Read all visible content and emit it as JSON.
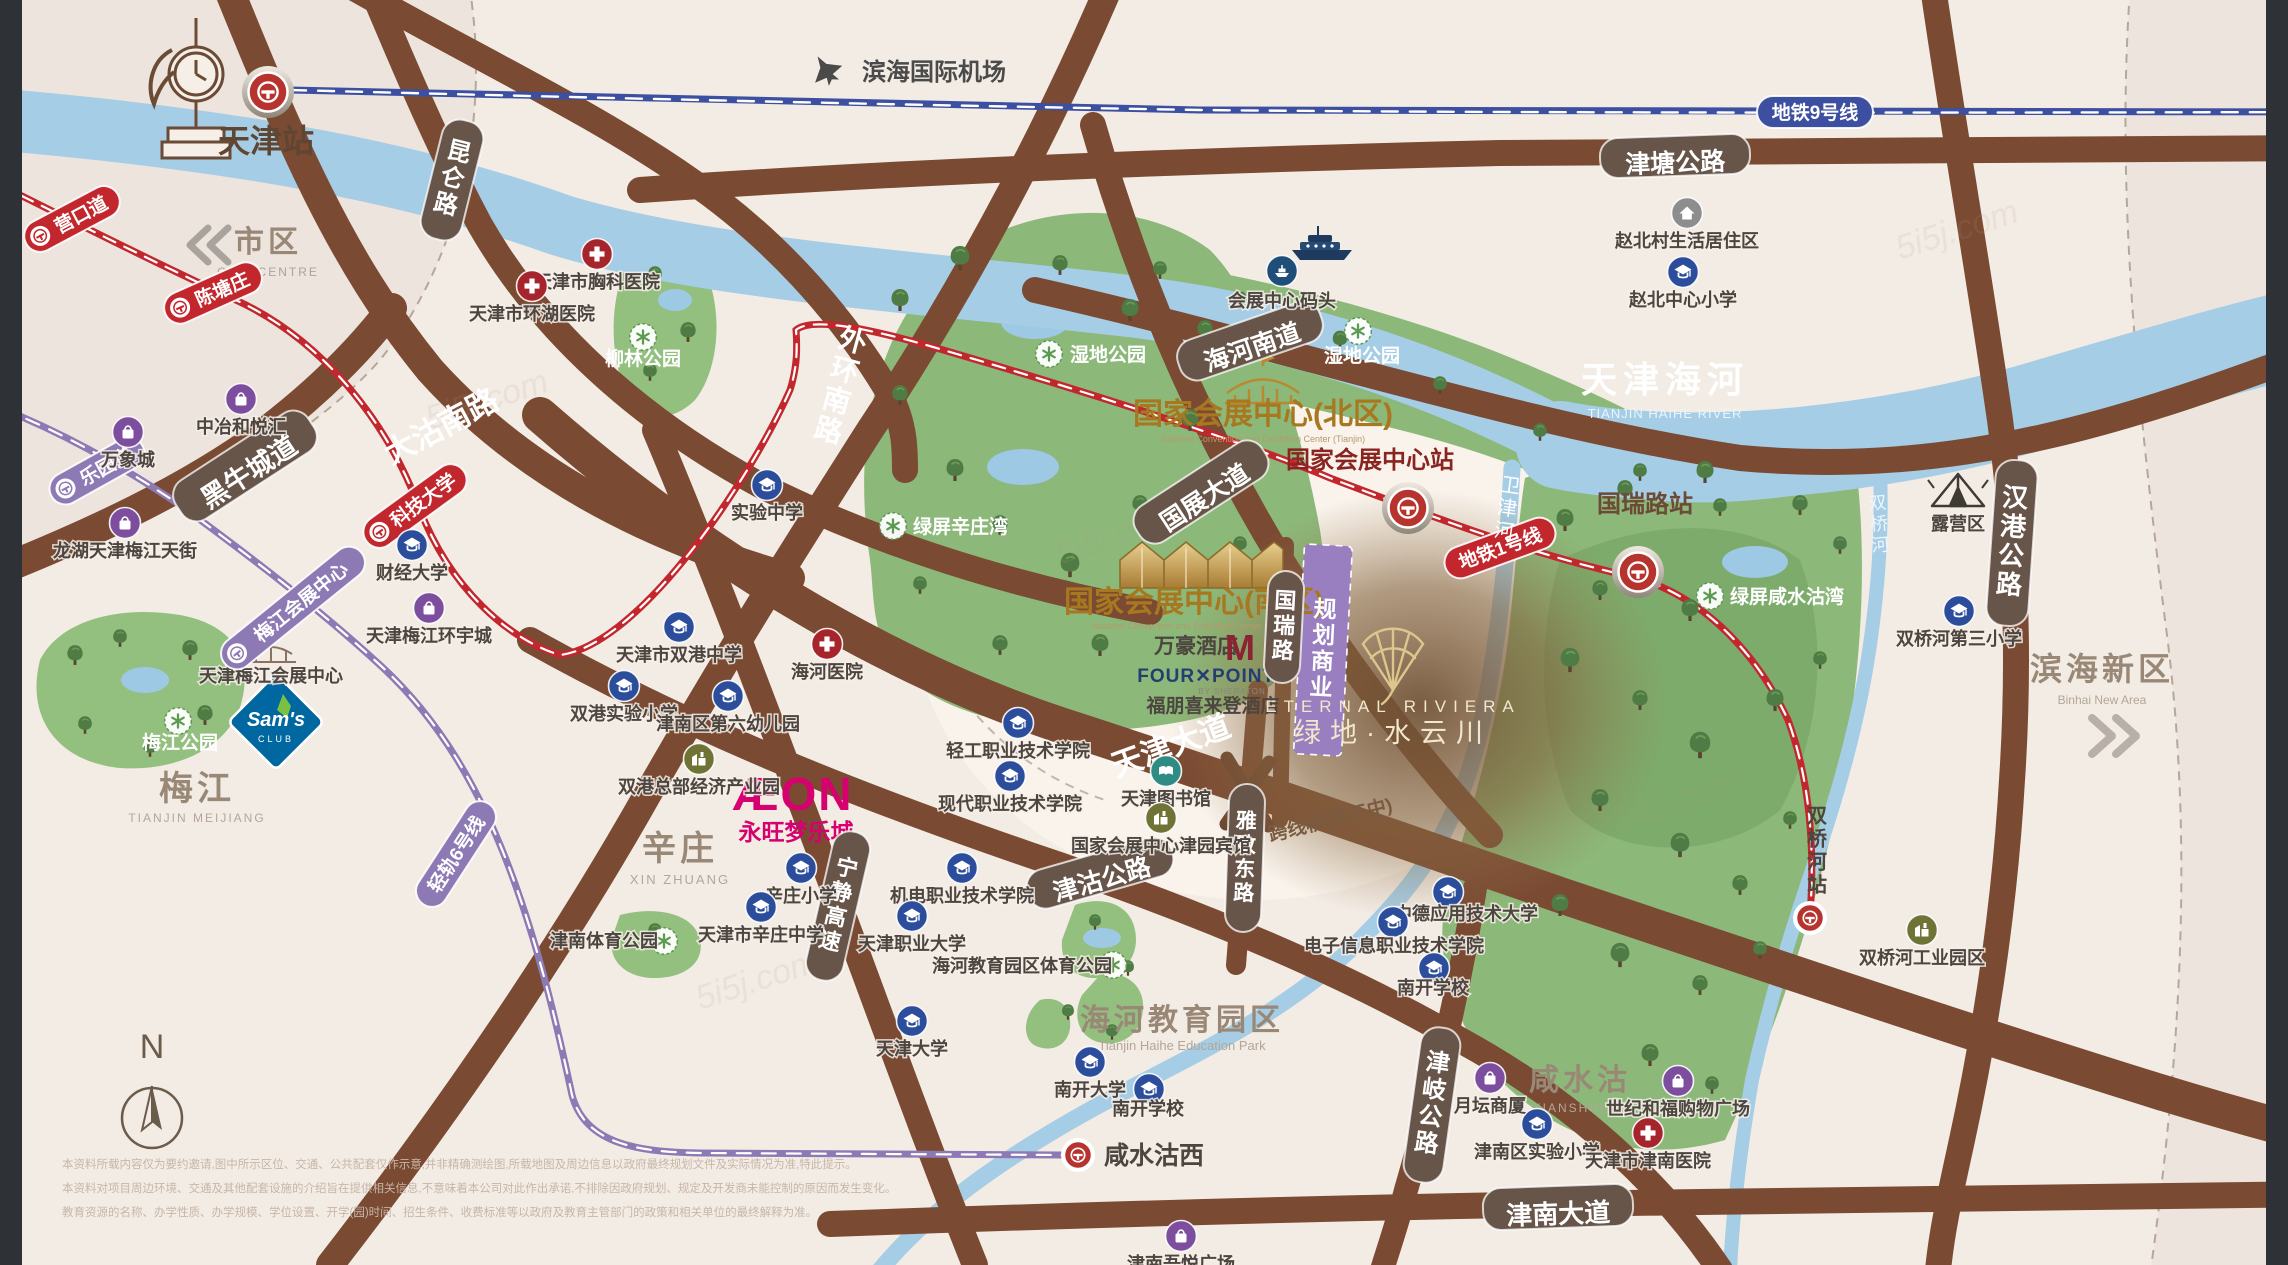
{
  "watermark": "5i5j.com",
  "compass": "N",
  "areas": {
    "city": {
      "label": "市区",
      "en": "CITY CENTRE"
    },
    "meijiang": {
      "label": "梅江",
      "en": "TIANJIN MEIJIANG"
    },
    "xinzhuang": {
      "label": "辛庄",
      "en": "XIN ZHUANG"
    },
    "xianshuigu": {
      "label": "咸水沽",
      "en": "XIANSHUIGU"
    },
    "haihe_edu": {
      "label": "海河教育园区",
      "en": "Tianjin Haihe Education Park"
    },
    "binhai": {
      "label": "滨海新区",
      "en": "Binhai New Area"
    },
    "river": {
      "label": "天津海河",
      "en": "TIANJIN HAIHE RIVER"
    },
    "weijin_river": "卫津河",
    "shuangqiao_river": "双桥河"
  },
  "landmarks": {
    "tianjin_station": "天津站",
    "airport": "滨海国际机场",
    "meijiang_center": "天津梅江会展中心"
  },
  "convention_north": {
    "title": "国家会展中心(北区)",
    "en": "National Convention and Exhibition Center (Tianjin)",
    "station": "国家会展中心站"
  },
  "convention_south": {
    "title": "国家会展中心(南区)",
    "en": "National Convention and Exhibition Center (Tianjin)",
    "hotel1": "万豪酒店",
    "hotel1_logo": "M",
    "hotel2_line1": "FOUR✕POINTS",
    "hotel2_line2": "BY SHERATON",
    "hotel2_cn": "福朋喜来登酒店"
  },
  "project": {
    "name_en": "ETERNAL RIVIERA",
    "name_cn": "绿地·水云川"
  },
  "planning": "规划商业",
  "bridge_note": "跨线桥(施工中)",
  "aeon": {
    "logo": "ÆON",
    "cn": "永旺梦乐城"
  },
  "sams": {
    "line1": "Sam's",
    "line2": "CLUB"
  },
  "guorui_station": "国瑞路站",
  "shuangqiaohe_station": "双桥河站",
  "xianshuigu_west_station": "咸水沽西",
  "metro": {
    "line1": "地铁1号线",
    "line9": "地铁9号线",
    "line6": "轻轨6号线"
  },
  "metro_stations": [
    "营口道",
    "陈塘庄",
    "科技大学",
    "乐园道",
    "梅江会展中心"
  ],
  "roads": [
    "大沽南路",
    "黑牛城道",
    "昆仑路",
    "津塘公路",
    "外环南路",
    "海河南道",
    "国展大道",
    "国瑞路",
    "天津大道",
    "津沽公路",
    "雅致东路",
    "宁静高速",
    "津岐公路",
    "津南大道",
    "汉港公路"
  ],
  "parks": [
    "湿地公园",
    "湿地公园",
    "柳林公园",
    "梅江公园",
    "绿屏辛庄湾",
    "绿屏咸水沽湾",
    "露营区",
    "津南体育公园",
    "海河教育园区体育公园"
  ],
  "pois": [
    {
      "label": "赵北村生活居住区",
      "type": "home"
    },
    {
      "label": "赵北中心小学",
      "type": "school"
    },
    {
      "label": "天津市胸科医院",
      "type": "hospital"
    },
    {
      "label": "天津市环湖医院",
      "type": "hospital"
    },
    {
      "label": "实验中学",
      "type": "school"
    },
    {
      "label": "财经大学",
      "type": "school"
    },
    {
      "label": "万象城",
      "type": "shop"
    },
    {
      "label": "中冶和悦汇",
      "type": "shop"
    },
    {
      "label": "龙湖天津梅江天街",
      "type": "shop"
    },
    {
      "label": "天津梅江环宇城",
      "type": "shop"
    },
    {
      "label": "天津市双港中学",
      "type": "school"
    },
    {
      "label": "双港实验小学",
      "type": "school"
    },
    {
      "label": "津南区第六幼儿园",
      "type": "school"
    },
    {
      "label": "双港总部经济产业园",
      "type": "industry"
    },
    {
      "label": "海河医院",
      "type": "hospital"
    },
    {
      "label": "辛庄小学",
      "type": "school"
    },
    {
      "label": "天津市辛庄中学",
      "type": "school"
    },
    {
      "label": "轻工职业技术学院",
      "type": "school"
    },
    {
      "label": "现代职业技术学院",
      "type": "school"
    },
    {
      "label": "机电职业技术学院",
      "type": "school"
    },
    {
      "label": "天津职业大学",
      "type": "school"
    },
    {
      "label": "天津图书馆",
      "type": "book"
    },
    {
      "label": "国家会展中心津园宾馆",
      "type": "industry"
    },
    {
      "label": "中德应用技术大学",
      "type": "school"
    },
    {
      "label": "电子信息职业技术学院",
      "type": "school"
    },
    {
      "label": "南开学校",
      "type": "school"
    },
    {
      "label": "南开大学",
      "type": "school"
    },
    {
      "label": "南开学校",
      "type": "school"
    },
    {
      "label": "天津大学",
      "type": "school"
    },
    {
      "label": "津南区实验小学",
      "type": "school"
    },
    {
      "label": "月坛商厦",
      "type": "shop"
    },
    {
      "label": "世纪和福购物广场",
      "type": "shop"
    },
    {
      "label": "天津市津南医院",
      "type": "hospital"
    },
    {
      "label": "津南吾悦广场",
      "type": "shop"
    },
    {
      "label": "双桥河第三小学",
      "type": "school"
    },
    {
      "label": "双桥河工业园区",
      "type": "industry"
    },
    {
      "label": "会展中心码头",
      "type": "ferry"
    }
  ],
  "camping_label": "露营区",
  "disclaimer": [
    "本资料所载内容仅为要约邀请,图中所示区位、交通、公共配套仅作示意,并非精确测绘图,所载地图及周边信息以政府最终规划文件及实际情况为准,特此提示。",
    "本资料对项目周边环境、交通及其他配套设施的介绍旨在提供相关信息,不意味着本公司对此作出承诺,不排除因政府规划、规定及开发商未能控制的原因而发生变化。",
    "教育资源的名称、办学性质、办学规模、学位设置、开学(园)时间、招生条件、收费标准等以政府及教育主管部门的政策和相关单位的最终解释为准。"
  ]
}
